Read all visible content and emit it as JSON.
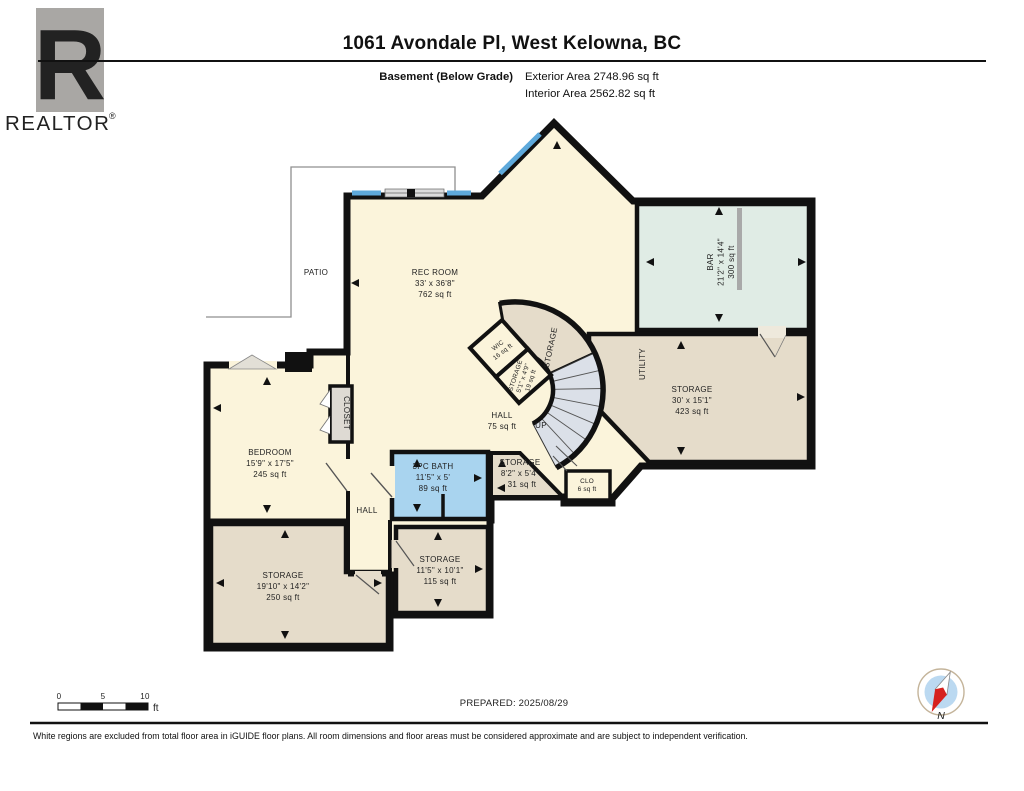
{
  "header": {
    "title": "1061 Avondale Pl, West Kelowna, BC",
    "floor_label": "Basement (Below Grade)",
    "exterior_area": "Exterior Area 2748.96 sq ft",
    "interior_area": "Interior Area 2562.82 sq ft"
  },
  "logo": {
    "r_glyph": "R",
    "brand": "REALTOR",
    "registered": "®"
  },
  "rooms": {
    "rec_room": {
      "name": "REC ROOM",
      "dims": "33' x 36'8\"",
      "area": "762 sq ft"
    },
    "bar": {
      "name": "BAR",
      "dims": "21'2\" x 14'4\"",
      "area": "300 sq ft"
    },
    "storage_main": {
      "name": "STORAGE",
      "dims": "30' x 15'1\"",
      "area": "423 sq ft"
    },
    "utility": {
      "name": "UTILITY"
    },
    "storage_curved": {
      "name": "STORAGE"
    },
    "wic": {
      "name": "WIC",
      "area": "16 sq ft"
    },
    "storage_stairs": {
      "name": "STORAGE",
      "dims": "5'1\" x 4'9\"",
      "area": "19 sq ft"
    },
    "hall": {
      "name": "HALL",
      "area": "75 sq ft"
    },
    "up": {
      "name": "UP"
    },
    "bedroom": {
      "name": "BEDROOM",
      "dims": "15'9\" x 17'5\"",
      "area": "245 sq ft"
    },
    "closet": {
      "name": "CLOSET"
    },
    "bath": {
      "name": "3PC BATH",
      "dims": "11'5\" x 5'",
      "area": "89 sq ft"
    },
    "storage_mid": {
      "name": "STORAGE",
      "dims": "8'2\" x 5'4\"",
      "area": "31 sq ft"
    },
    "clo": {
      "name": "CLO",
      "area": "6 sq ft"
    },
    "hall_lower": {
      "name": "HALL"
    },
    "storage_sw": {
      "name": "STORAGE",
      "dims": "19'10\" x 14'2\"",
      "area": "250 sq ft"
    },
    "storage_s": {
      "name": "STORAGE",
      "dims": "11'5\" x 10'1\"",
      "area": "115 sq ft"
    },
    "patio": {
      "name": "PATIO"
    }
  },
  "scale_bar": {
    "tick_0": "0",
    "tick_5": "5",
    "tick_10": "10",
    "unit": "ft"
  },
  "prepared": "PREPARED: 2025/08/29",
  "compass": {
    "label": "N"
  },
  "footer": "White regions are excluded from total floor area in iGUIDE floor plans. All room dimensions and floor areas must be considered approximate and are subject to independent verification.",
  "colors": {
    "wall": "#111111",
    "cream": "#FBF4DB",
    "tan": "#E5DCCA",
    "bar_green": "#E0ECE5",
    "bath_blue": "#A9D4EF",
    "window_blue": "#5EA9DB",
    "stair_gray": "#DBE0E8",
    "closet_gray": "#DEDAD3",
    "logo_gray": "#A9A7A4",
    "compass_red": "#D6211E",
    "compass_blue": "#BBD9F1"
  }
}
